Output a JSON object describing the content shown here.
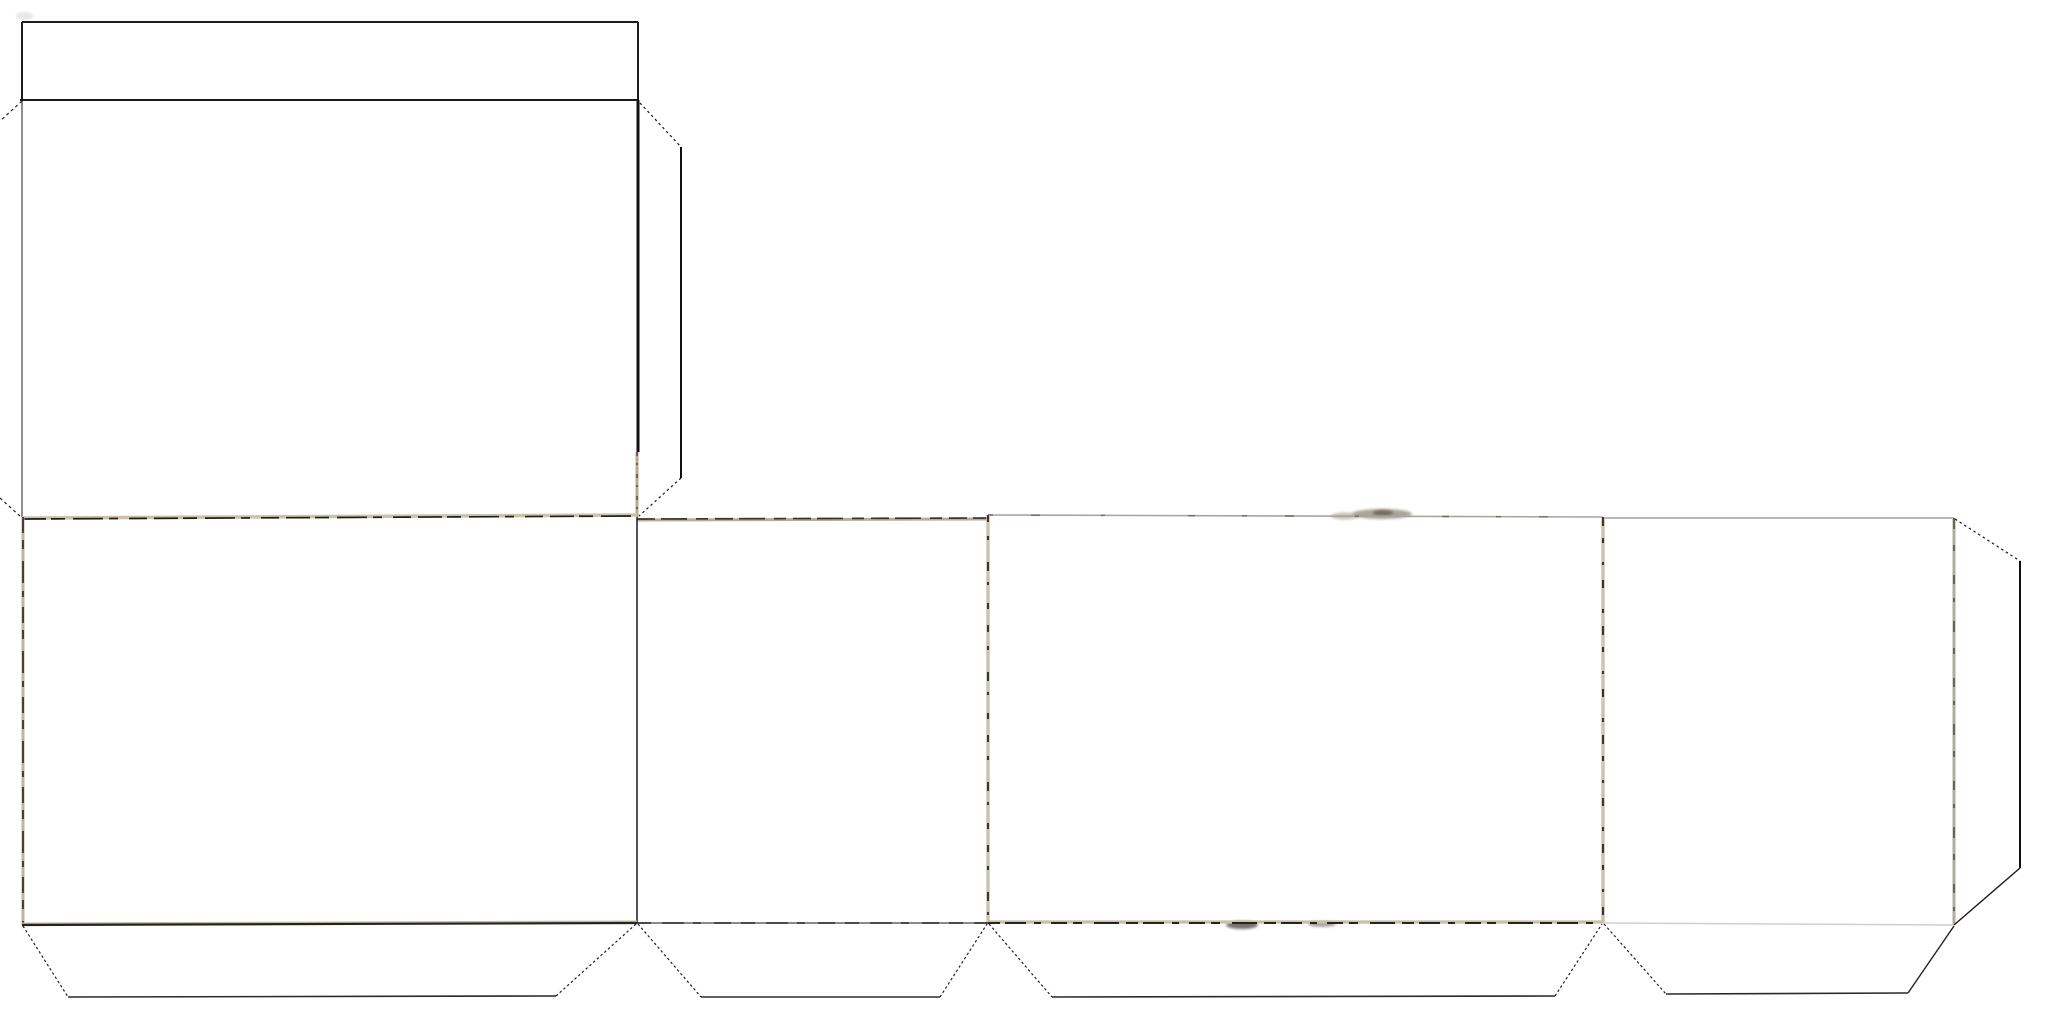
{
  "document": {
    "description": "Scanned papercraft template: unfolded rectangular box net with lid flap, four side panels, glue flaps and dotted cut-corner lines. No visible text.",
    "background_color": "#ffffff",
    "ink_color": "#1d1b18",
    "tan_fold_color": "#cbc2aa",
    "gray_edge_color": "#8f8f8f"
  },
  "net": {
    "canvas": {
      "width": 2050,
      "height": 1024
    },
    "regions": [
      {
        "name": "lid-flap",
        "x": 22,
        "y": 22,
        "w": 616,
        "h": 78
      },
      {
        "name": "top-panel",
        "x": 22,
        "y": 100,
        "w": 616,
        "h": 417
      },
      {
        "name": "right-glue-flap",
        "x": 638,
        "y": 103,
        "w": 43,
        "h": 413
      },
      {
        "name": "panel-1-wide",
        "x": 22,
        "y": 517,
        "w": 615,
        "h": 407
      },
      {
        "name": "panel-2-narrow",
        "x": 637,
        "y": 517,
        "w": 351,
        "h": 406
      },
      {
        "name": "panel-3-wide",
        "x": 988,
        "y": 515,
        "w": 615,
        "h": 408
      },
      {
        "name": "panel-4-narrow",
        "x": 1603,
        "y": 518,
        "w": 351,
        "h": 406
      },
      {
        "name": "end-glue-flap",
        "x": 1954,
        "y": 518,
        "w": 66,
        "h": 407
      },
      {
        "name": "bottom-glue-flap-1",
        "x": 22,
        "y": 923,
        "w": 615,
        "h": 74
      },
      {
        "name": "bottom-glue-flap-2",
        "x": 637,
        "y": 923,
        "w": 351,
        "h": 74
      },
      {
        "name": "bottom-glue-flap-3",
        "x": 988,
        "y": 923,
        "w": 615,
        "h": 74
      },
      {
        "name": "bottom-glue-flap-4",
        "x": 1603,
        "y": 923,
        "w": 351,
        "h": 71
      }
    ],
    "strokes": [
      {
        "name": "lid-top-edge",
        "points": [
          [
            22,
            22
          ],
          [
            638,
            22
          ]
        ],
        "color": "#1c1c1c",
        "width": 2
      },
      {
        "name": "lid-left-edge",
        "points": [
          [
            22,
            22
          ],
          [
            22,
            101
          ]
        ],
        "color": "#1c1c1c",
        "width": 2
      },
      {
        "name": "lid-right-edge",
        "points": [
          [
            638,
            22
          ],
          [
            638,
            100
          ]
        ],
        "color": "#1c1c1c",
        "width": 2
      },
      {
        "name": "lid-fold-line",
        "points": [
          [
            20,
            100
          ],
          [
            638,
            100
          ]
        ],
        "color": "#191919",
        "width": 2
      },
      {
        "name": "top-panel-left-edge",
        "points": [
          [
            22,
            101
          ],
          [
            22,
            517
          ]
        ],
        "color": "#8f8f8f",
        "width": 2
      },
      {
        "name": "top-panel-right-edge",
        "points": [
          [
            638,
            100
          ],
          [
            638,
            452
          ]
        ],
        "color": "#14110e",
        "width": 3
      },
      {
        "name": "top-panel-right-edge-tan",
        "points": [
          [
            637,
            452
          ],
          [
            637,
            517
          ]
        ],
        "color": "#b7ab8f",
        "width": 3
      },
      {
        "name": "top-panel-right-edge-speck",
        "points": [
          [
            637,
            452
          ],
          [
            637,
            517
          ]
        ],
        "color": "#3a332a",
        "width": 1.2,
        "dash": "4 7 2 9"
      },
      {
        "name": "cut-corner-top-left",
        "points": [
          [
            22,
            101
          ],
          [
            0,
            121
          ]
        ],
        "color": "#20242c",
        "width": 1.2,
        "dash": "3 3"
      },
      {
        "name": "cut-corner-mid-left",
        "points": [
          [
            0,
            498
          ],
          [
            21,
            517
          ]
        ],
        "color": "#20242c",
        "width": 1.2,
        "dash": "3 3"
      },
      {
        "name": "right-flap-cut-top",
        "points": [
          [
            640,
            103
          ],
          [
            681,
            147
          ]
        ],
        "color": "#15171c",
        "width": 1.2,
        "dash": "2.5 3"
      },
      {
        "name": "right-flap-outer-edge",
        "points": [
          [
            681,
            147
          ],
          [
            681,
            478
          ]
        ],
        "color": "#101010",
        "width": 2
      },
      {
        "name": "right-flap-cut-bottom",
        "points": [
          [
            681,
            478
          ],
          [
            639,
            516
          ]
        ],
        "color": "#15171c",
        "width": 1.2,
        "dash": "2.5 3"
      },
      {
        "name": "row-top-fold-1-tan",
        "points": [
          [
            22,
            518
          ],
          [
            637,
            515
          ]
        ],
        "color": "#cbc2aa",
        "width": 3.5
      },
      {
        "name": "row-top-fold-1-ink",
        "points": [
          [
            22,
            519
          ],
          [
            637,
            516
          ]
        ],
        "color": "#211c15",
        "width": 1.7,
        "dash": "24 5 14 8 30 6 9 11 18 7"
      },
      {
        "name": "row-top-fold-2-tan",
        "points": [
          [
            637,
            520
          ],
          [
            988,
            519
          ]
        ],
        "color": "#b5ad9b",
        "width": 3
      },
      {
        "name": "row-top-fold-2-ink",
        "points": [
          [
            637,
            519
          ],
          [
            988,
            518
          ]
        ],
        "color": "#37322b",
        "width": 1.7,
        "dash": "18 6 26 9 12 7"
      },
      {
        "name": "row-top-fold-3",
        "points": [
          [
            988,
            515
          ],
          [
            1603,
            517
          ]
        ],
        "color": "#a8a49c",
        "width": 1.6
      },
      {
        "name": "row-top-fold-3-speck",
        "points": [
          [
            988,
            515
          ],
          [
            1603,
            517
          ]
        ],
        "color": "#6e675c",
        "width": 1.4,
        "dash": "5 38 9 61 4 83 7 47"
      },
      {
        "name": "row-top-fold-4",
        "points": [
          [
            1603,
            518
          ],
          [
            1954,
            518
          ]
        ],
        "color": "#a0a0a0",
        "width": 1.6
      },
      {
        "name": "row-left-edge-tan",
        "points": [
          [
            23,
            517
          ],
          [
            23,
            925
          ]
        ],
        "color": "#c0b69e",
        "width": 3
      },
      {
        "name": "row-left-edge-ink",
        "points": [
          [
            23,
            517
          ],
          [
            23,
            925
          ]
        ],
        "color": "#2c2218",
        "width": 1.6,
        "dash": "16 7 9 12 22 8 6 10"
      },
      {
        "name": "panel-divider-1-2",
        "points": [
          [
            637,
            517
          ],
          [
            637,
            923
          ]
        ],
        "color": "#232833",
        "width": 1.6
      },
      {
        "name": "panel-divider-2-3-tan",
        "points": [
          [
            988,
            515
          ],
          [
            988,
            923
          ]
        ],
        "color": "#cdc4ae",
        "width": 3.5
      },
      {
        "name": "panel-divider-2-3-speck",
        "points": [
          [
            988,
            515
          ],
          [
            988,
            923
          ]
        ],
        "color": "#2a2520",
        "width": 1.8,
        "dash": "7 14 4 22 9 11 3 18 6 16"
      },
      {
        "name": "panel-divider-3-4-tan",
        "points": [
          [
            1603,
            517
          ],
          [
            1603,
            923
          ]
        ],
        "color": "#cdc4ae",
        "width": 3.5
      },
      {
        "name": "panel-divider-3-4-speck",
        "points": [
          [
            1603,
            517
          ],
          [
            1603,
            923
          ]
        ],
        "color": "#2a2520",
        "width": 1.8,
        "dash": "9 12 5 19 3 15 8 21 4 13"
      },
      {
        "name": "row-right-edge-tan",
        "points": [
          [
            1954,
            518
          ],
          [
            1954,
            925
          ]
        ],
        "color": "#b3ac9c",
        "width": 3
      },
      {
        "name": "row-right-edge-speck",
        "points": [
          [
            1954,
            518
          ],
          [
            1954,
            925
          ]
        ],
        "color": "#58524a",
        "width": 1.6,
        "dash": "11 16 6 24 9 14 4 19"
      },
      {
        "name": "row-bottom-fold-1-tan",
        "points": [
          [
            22,
            924
          ],
          [
            637,
            922
          ]
        ],
        "color": "#c3baa4",
        "width": 3
      },
      {
        "name": "row-bottom-fold-1-ink",
        "points": [
          [
            22,
            925
          ],
          [
            637,
            923
          ]
        ],
        "color": "#26221c",
        "width": 2.2
      },
      {
        "name": "row-bottom-fold-2",
        "points": [
          [
            637,
            923
          ],
          [
            988,
            923
          ]
        ],
        "color": "#8a8a8a",
        "width": 2
      },
      {
        "name": "row-bottom-fold-2-speck",
        "points": [
          [
            637,
            923
          ],
          [
            988,
            923
          ]
        ],
        "color": "#37332d",
        "width": 1.6,
        "dash": "14 11 22 9 8 13 17 10"
      },
      {
        "name": "row-bottom-fold-3-tan",
        "points": [
          [
            988,
            922
          ],
          [
            1603,
            922
          ]
        ],
        "color": "#c8bfa9",
        "width": 3.2
      },
      {
        "name": "row-bottom-fold-3-ink",
        "points": [
          [
            988,
            923
          ],
          [
            1603,
            923
          ]
        ],
        "color": "#28231d",
        "width": 1.9,
        "dash": "12 5 21 8 7 10 16 6 9 12 25 7"
      },
      {
        "name": "row-bottom-fold-4",
        "points": [
          [
            1603,
            923
          ],
          [
            1954,
            925
          ]
        ],
        "color": "#cfcfcf",
        "width": 1.5
      },
      {
        "name": "bottom-flap-1-left-cut",
        "points": [
          [
            23,
            926
          ],
          [
            68,
            997
          ]
        ],
        "color": "#1c1f26",
        "width": 1.2,
        "dash": "2.5 2.5"
      },
      {
        "name": "bottom-flap-1-bottom-edge",
        "points": [
          [
            68,
            997
          ],
          [
            556,
            996
          ]
        ],
        "color": "#2a2a2a",
        "width": 1.6
      },
      {
        "name": "bottom-flap-1-right-cut",
        "points": [
          [
            556,
            996
          ],
          [
            636,
            924
          ]
        ],
        "color": "#1c1f26",
        "width": 1.2,
        "dash": "2.5 2.5"
      },
      {
        "name": "bottom-flap-2-left-cut",
        "points": [
          [
            638,
            924
          ],
          [
            701,
            997
          ]
        ],
        "color": "#1c1f26",
        "width": 1.2,
        "dash": "2.5 2.5"
      },
      {
        "name": "bottom-flap-2-bottom-edge",
        "points": [
          [
            701,
            997
          ],
          [
            940,
            997
          ]
        ],
        "color": "#2a2a2a",
        "width": 1.6
      },
      {
        "name": "bottom-flap-2-right-cut",
        "points": [
          [
            940,
            997
          ],
          [
            987,
            924
          ]
        ],
        "color": "#1c1f26",
        "width": 1.2,
        "dash": "2.5 2.5"
      },
      {
        "name": "bottom-flap-3-left-cut",
        "points": [
          [
            989,
            924
          ],
          [
            1052,
            997
          ]
        ],
        "color": "#1c1f26",
        "width": 1.2,
        "dash": "2.5 2.5"
      },
      {
        "name": "bottom-flap-3-bottom-edge",
        "points": [
          [
            1052,
            997
          ],
          [
            1555,
            996
          ]
        ],
        "color": "#2a2a2a",
        "width": 1.6
      },
      {
        "name": "bottom-flap-3-right-cut",
        "points": [
          [
            1555,
            996
          ],
          [
            1602,
            924
          ]
        ],
        "color": "#1c1f26",
        "width": 1.2,
        "dash": "2.5 2.5"
      },
      {
        "name": "bottom-flap-4-left-cut",
        "points": [
          [
            1604,
            924
          ],
          [
            1666,
            994
          ]
        ],
        "color": "#1c1f26",
        "width": 1.2,
        "dash": "2.5 2.5"
      },
      {
        "name": "bottom-flap-4-bottom-edge",
        "points": [
          [
            1666,
            994
          ],
          [
            1908,
            993
          ]
        ],
        "color": "#2a2a2a",
        "width": 1.6
      },
      {
        "name": "bottom-flap-4-right-cut",
        "points": [
          [
            1908,
            993
          ],
          [
            1954,
            926
          ]
        ],
        "color": "#24221f",
        "width": 1.4
      },
      {
        "name": "end-flap-cut-top",
        "points": [
          [
            1955,
            519
          ],
          [
            2020,
            561
          ]
        ],
        "color": "#15171c",
        "width": 1.2,
        "dash": "2.5 3"
      },
      {
        "name": "end-flap-outer-edge",
        "points": [
          [
            2020,
            561
          ],
          [
            2020,
            868
          ]
        ],
        "color": "#0f0f0f",
        "width": 2
      },
      {
        "name": "end-flap-cut-bottom",
        "points": [
          [
            2020,
            868
          ],
          [
            1954,
            925
          ]
        ],
        "color": "#1a1a1a",
        "width": 1.4
      }
    ],
    "smudges": [
      {
        "name": "tape-smudge-panel3-top-wide",
        "cx": 1382,
        "cy": 514,
        "rx": 30,
        "ry": 5,
        "color": "#8f8677",
        "opacity": 0.75,
        "blur": true
      },
      {
        "name": "tape-smudge-panel3-top-left",
        "cx": 1345,
        "cy": 516,
        "rx": 14,
        "ry": 3.5,
        "color": "#b0a896",
        "opacity": 0.7,
        "blur": true
      },
      {
        "name": "tape-smudge-panel3-top-core",
        "cx": 1383,
        "cy": 513,
        "rx": 10,
        "ry": 3,
        "color": "#6b6459",
        "opacity": 0.85,
        "blur": true
      },
      {
        "name": "smudge-panel3-bottom-left",
        "cx": 1242,
        "cy": 925,
        "rx": 16,
        "ry": 4,
        "color": "#4a453d",
        "opacity": 0.75,
        "blur": true
      },
      {
        "name": "smudge-panel3-bottom-right",
        "cx": 1322,
        "cy": 924,
        "rx": 14,
        "ry": 3,
        "color": "#6e6a60",
        "opacity": 0.6,
        "blur": true
      },
      {
        "name": "lid-corner-ghost-mark",
        "cx": 25,
        "cy": 16,
        "rx": 9,
        "ry": 4,
        "color": "#d9d9d9",
        "opacity": 0.6,
        "blur": true
      }
    ]
  }
}
